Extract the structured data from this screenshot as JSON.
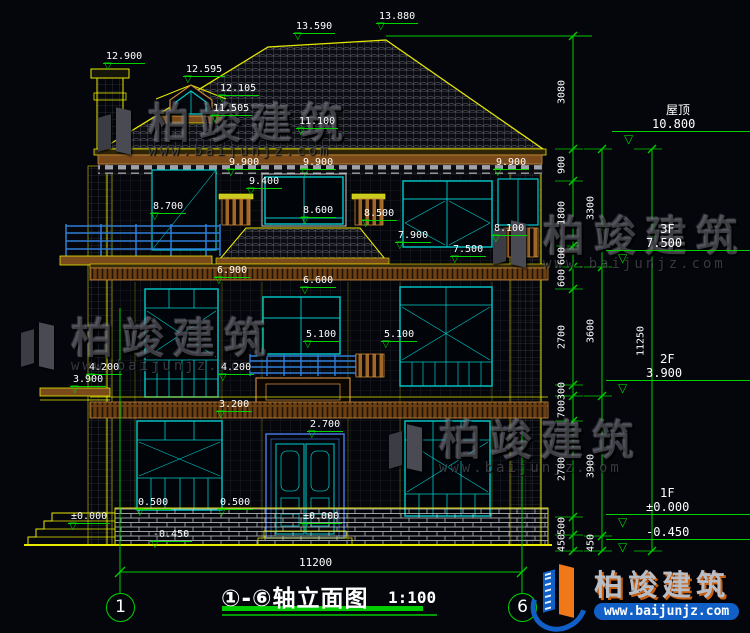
{
  "title": {
    "text": "①-⑥轴立面图",
    "scale": "1:100"
  },
  "bottom_dim": {
    "label": "11200"
  },
  "axis_bubbles": [
    {
      "label": "1",
      "x": 106,
      "y": 593
    },
    {
      "label": "6",
      "x": 508,
      "y": 593
    }
  ],
  "colors": {
    "background": "#04060b",
    "line_yellow": "#e8e800",
    "dim_green": "#00d400",
    "window_teal": "#00cccc",
    "trim_brown": "#c8873c",
    "door_blue": "#3f6fd0",
    "text_white": "#ffffff",
    "brand_blue": "#1060c8",
    "brand_orange": "#f07818"
  },
  "annotations": [
    {
      "t": "12.900",
      "x": 103,
      "y": 51
    },
    {
      "t": "13.590",
      "x": 293,
      "y": 21
    },
    {
      "t": "13.880",
      "x": 376,
      "y": 11
    },
    {
      "t": "12.595",
      "x": 183,
      "y": 64
    },
    {
      "t": "12.105",
      "x": 217,
      "y": 83
    },
    {
      "t": "11.505",
      "x": 210,
      "y": 103
    },
    {
      "t": "11.100",
      "x": 296,
      "y": 116
    },
    {
      "t": "9.900",
      "x": 226,
      "y": 157
    },
    {
      "t": "9.900",
      "x": 300,
      "y": 157
    },
    {
      "t": "9.900",
      "x": 493,
      "y": 157
    },
    {
      "t": "9.400",
      "x": 246,
      "y": 176
    },
    {
      "t": "8.700",
      "x": 150,
      "y": 201
    },
    {
      "t": "8.600",
      "x": 300,
      "y": 205
    },
    {
      "t": "8.500",
      "x": 361,
      "y": 208
    },
    {
      "t": "8.100",
      "x": 491,
      "y": 223
    },
    {
      "t": "7.900",
      "x": 395,
      "y": 230
    },
    {
      "t": "7.500",
      "x": 450,
      "y": 244
    },
    {
      "t": "6.900",
      "x": 214,
      "y": 265
    },
    {
      "t": "6.600",
      "x": 300,
      "y": 275
    },
    {
      "t": "5.100",
      "x": 303,
      "y": 329
    },
    {
      "t": "5.100",
      "x": 381,
      "y": 329
    },
    {
      "t": "4.200",
      "x": 86,
      "y": 362
    },
    {
      "t": "4.200",
      "x": 218,
      "y": 362
    },
    {
      "t": "3.900",
      "x": 70,
      "y": 374
    },
    {
      "t": "3.200",
      "x": 216,
      "y": 399
    },
    {
      "t": "2.700",
      "x": 307,
      "y": 419
    },
    {
      "t": "0.500",
      "x": 135,
      "y": 497
    },
    {
      "t": "0.500",
      "x": 217,
      "y": 497
    },
    {
      "t": "±0.000",
      "x": 68,
      "y": 511
    },
    {
      "t": "±0.000",
      "x": 300,
      "y": 511
    },
    {
      "t": "-0.450",
      "x": 150,
      "y": 529
    }
  ],
  "floor_markers": [
    {
      "name": "屋顶",
      "value": "10.800",
      "x": 612,
      "y": 103
    },
    {
      "name": "3F",
      "value": "7.500",
      "x": 606,
      "y": 222
    },
    {
      "name": "2F",
      "value": "3.900",
      "x": 606,
      "y": 352
    },
    {
      "name": "1F",
      "value": "±0.000",
      "x": 606,
      "y": 486
    },
    {
      "name": "",
      "value": "-0.450",
      "x": 606,
      "y": 525
    }
  ],
  "dim_chains": [
    {
      "x": 573,
      "ticks": [
        36,
        149,
        181,
        246,
        267,
        289,
        385,
        396,
        421,
        517,
        535,
        551
      ],
      "labels": [
        {
          "t": "3080",
          "y": 92
        },
        {
          "t": "900",
          "y": 165
        },
        {
          "t": "1800",
          "y": 213
        },
        {
          "t": "600",
          "y": 256
        },
        {
          "t": "600",
          "y": 278
        },
        {
          "t": "2700",
          "y": 337
        },
        {
          "t": "300",
          "y": 391
        },
        {
          "t": "700",
          "y": 409
        },
        {
          "t": "2700",
          "y": 469
        },
        {
          "t": "500",
          "y": 526
        },
        {
          "t": "450",
          "y": 543
        }
      ]
    },
    {
      "x": 602,
      "ticks": [
        149,
        267,
        396,
        536,
        551
      ],
      "labels": [
        {
          "t": "3300",
          "y": 208
        },
        {
          "t": "3600",
          "y": 331
        },
        {
          "t": "3900",
          "y": 466
        },
        {
          "t": "450",
          "y": 543
        }
      ]
    },
    {
      "x": 652,
      "ticks": [
        149,
        551
      ],
      "labels": [
        {
          "t": "11250",
          "y": 341
        }
      ]
    }
  ],
  "watermarks": {
    "brand": "柏竣建筑",
    "url": "www.baijunjz.com",
    "positions": [
      {
        "x": 95,
        "y": 103
      },
      {
        "x": 490,
        "y": 216
      },
      {
        "x": 18,
        "y": 318
      },
      {
        "x": 386,
        "y": 420
      }
    ]
  },
  "brand_logo": {
    "name": "柏竣建筑",
    "url": "www.baijunjz.com"
  }
}
